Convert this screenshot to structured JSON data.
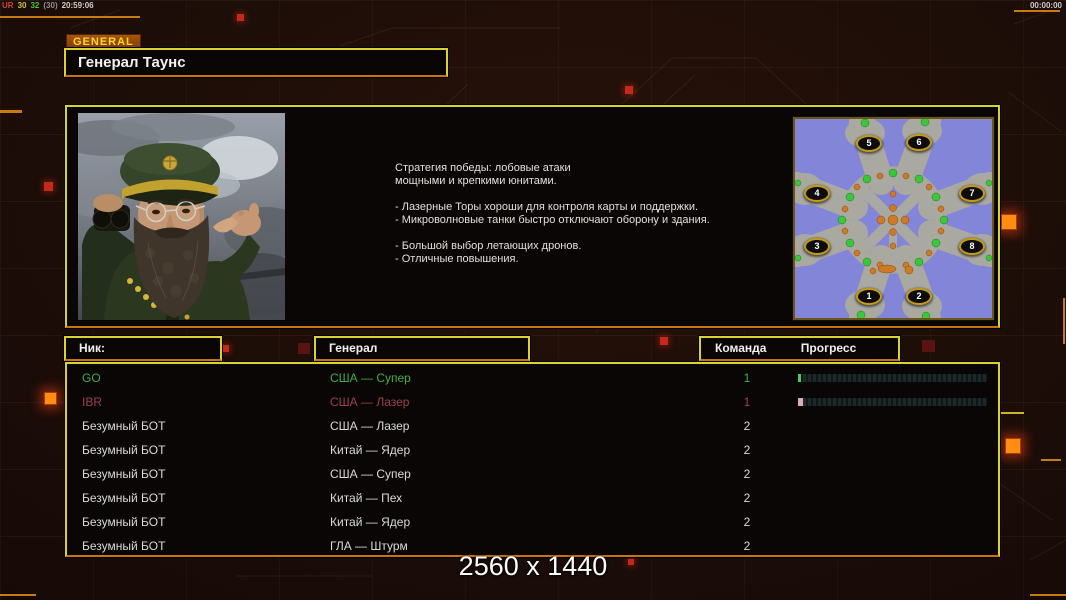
{
  "hud": {
    "debug_segments": [
      {
        "text": "UR",
        "color": "#cf4638"
      },
      {
        "text": "30",
        "color": "#cfc23a"
      },
      {
        "text": "32",
        "color": "#49c43f"
      },
      {
        "text": "(30)",
        "color": "#8f8f8f"
      },
      {
        "text": "20:59:06",
        "color": "#cfcfcf"
      }
    ],
    "match_timer": "00:00:00",
    "resolution_watermark": "2560 x 1440"
  },
  "header": {
    "category_tab": "GENERAL",
    "selected_general": "Генерал Таунс"
  },
  "briefing": {
    "lines": [
      "Стратегия победы: лобовые атаки",
      "мощными и крепкими юнитами.",
      "",
      "- Лазерные Торы хороши для контроля карты и поддержки.",
      "- Микроволновые танки быстро отключают оборону и здания.",
      "",
      "- Большой выбор летающих дронов.",
      "- Отличные повышения."
    ]
  },
  "minimap": {
    "start_positions": [
      "1",
      "2",
      "3",
      "4",
      "5",
      "6",
      "7",
      "8"
    ]
  },
  "roster": {
    "columns": {
      "nick": "Ник:",
      "general": "Генерал",
      "team": "Команда",
      "progress": "Прогресс"
    },
    "players": [
      {
        "nick": "GO",
        "general": "США — Супер",
        "team": "1",
        "text_color": "#43ad43",
        "bar": true,
        "bar_fill": "#52c852",
        "progress_pct": 1.5
      },
      {
        "nick": "IBR",
        "general": "США — Лазер",
        "team": "1",
        "text_color": "#9a4348",
        "bar": true,
        "bar_fill": "#e2aab8",
        "progress_pct": 2.5
      },
      {
        "nick": "Безумный БОТ",
        "general": "США — Лазер",
        "team": "2",
        "text_color": "#d9d9d9",
        "bar": false,
        "bar_fill": "",
        "progress_pct": 0
      },
      {
        "nick": "Безумный БОТ",
        "general": "Китай — Ядер",
        "team": "2",
        "text_color": "#d9d9d9",
        "bar": false,
        "bar_fill": "",
        "progress_pct": 0
      },
      {
        "nick": "Безумный БОТ",
        "general": "США — Супер",
        "team": "2",
        "text_color": "#d9d9d9",
        "bar": false,
        "bar_fill": "",
        "progress_pct": 0
      },
      {
        "nick": "Безумный БОТ",
        "general": "Китай — Пех",
        "team": "2",
        "text_color": "#d9d9d9",
        "bar": false,
        "bar_fill": "",
        "progress_pct": 0
      },
      {
        "nick": "Безумный БОТ",
        "general": "Китай — Ядер",
        "team": "2",
        "text_color": "#d9d9d9",
        "bar": false,
        "bar_fill": "",
        "progress_pct": 0
      },
      {
        "nick": "Безумный БОТ",
        "general": "ГЛА — Штурм",
        "team": "2",
        "text_color": "#d9d9d9",
        "bar": false,
        "bar_fill": "",
        "progress_pct": 0
      }
    ]
  },
  "accents": {
    "border_yellow": "#d9d42a",
    "border_orange": "#c9750f",
    "square_red": "#c4291c",
    "square_orange": "#ff8d12",
    "minimap_water": "#8285d8",
    "minimap_land": "#a9a9a1"
  }
}
